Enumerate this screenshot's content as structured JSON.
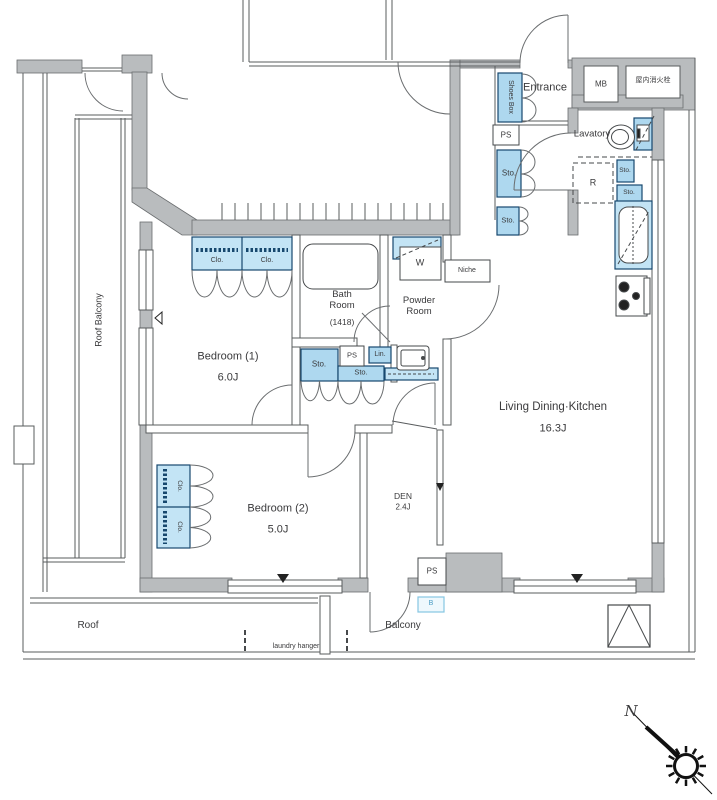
{
  "labels": {
    "entrance": "Entrance",
    "mb": "MB",
    "fire_hydrant": "屋内消火栓",
    "lavatory": "Lavatory",
    "shoes_box": "Shoes Box",
    "ps": "PS",
    "sto": "Sto.",
    "clo": "Clo.",
    "lin": "Lin.",
    "washer": "W",
    "fridge": "R",
    "niche": "Niche",
    "bath": {
      "name": "Bath Room",
      "size": "(1418)"
    },
    "powder": "Powder Room",
    "bedroom1": {
      "name": "Bedroom (1)",
      "size": "6.0J"
    },
    "bedroom2": {
      "name": "Bedroom (2)",
      "size": "5.0J"
    },
    "den": {
      "name": "DEN",
      "size": "2.4J"
    },
    "ldk": {
      "name": "Living Dining·Kitchen",
      "size": "16.3J"
    },
    "roof_balcony": "Roof Balcony",
    "roof": "Roof",
    "balcony": "Balcony",
    "laundry_hanger": "laundry hanger",
    "b_mark": "B",
    "compass_north": "N"
  },
  "colors": {
    "wall": "#b9bcbe",
    "line": "#595c5e",
    "fixture_fill": "#aed8ef",
    "fixture_fill_light": "#c3e4f5",
    "fixture_border": "#17486e",
    "b_mark": "#4a9cc4"
  }
}
